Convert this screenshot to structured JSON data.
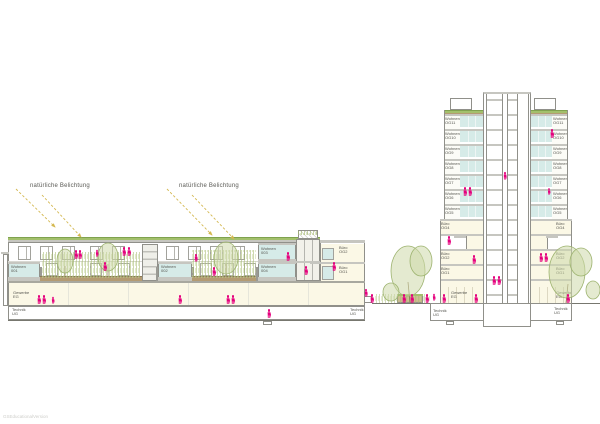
{
  "annotations": {
    "natural_light_1": "natürliche Belichtung",
    "natural_light_2": "natürliche Belichtung"
  },
  "watermark": "GSEducationalVersion",
  "colors": {
    "magenta": "#e5007d",
    "glazing": "#d6ebe8",
    "room_cream": "#fbf8e6",
    "roof_green": "#a3c06c",
    "soil_brown": "#b49b72",
    "arrow_yellow": "#d4b850",
    "plant_green": "#a7bb70",
    "line_gray": "#90908a"
  },
  "left_building": {
    "units": [
      {
        "name": "Wohnen",
        "num": "001"
      },
      {
        "name": "Wohnen",
        "num": "002"
      },
      {
        "name": "Wohnen",
        "num": "003"
      },
      {
        "name": "Wohnen",
        "num": "004"
      }
    ],
    "office_block": {
      "floors": [
        {
          "name": "Büro",
          "num": "OG2"
        },
        {
          "name": "Büro",
          "num": "OG1"
        },
        {
          "name": "Büro",
          "num": "EG"
        }
      ],
      "basement": {
        "name": "Technik",
        "num": "UG"
      }
    },
    "podium": {
      "commercial": {
        "name": "Gewerbe",
        "num": "EG"
      },
      "basement": {
        "name": "Technik",
        "num": "UG"
      }
    }
  },
  "tower": {
    "left_wing_floors": [
      {
        "name": "Wohnen",
        "num": "OG11",
        "type": "wohnen"
      },
      {
        "name": "Wohnen",
        "num": "OG10",
        "type": "wohnen"
      },
      {
        "name": "Wohnen",
        "num": "OG9",
        "type": "wohnen"
      },
      {
        "name": "Wohnen",
        "num": "OG8",
        "type": "wohnen"
      },
      {
        "name": "Wohnen",
        "num": "OG7",
        "type": "wohnen"
      },
      {
        "name": "Wohnen",
        "num": "OG6",
        "type": "wohnen"
      },
      {
        "name": "Wohnen",
        "num": "OG5",
        "type": "wohnen"
      },
      {
        "name": "Büro",
        "num": "OG4",
        "type": "buero"
      },
      {
        "type": "terrace"
      },
      {
        "name": "Büro",
        "num": "OG2",
        "type": "buero"
      },
      {
        "name": "Büro",
        "num": "OG1",
        "type": "buero"
      },
      {
        "name": "Gewerbe",
        "num": "EG",
        "type": "gewerbe"
      }
    ],
    "right_wing_floors": [
      {
        "name": "Wohnen",
        "num": "OG11",
        "type": "wohnen"
      },
      {
        "name": "Wohnen",
        "num": "OG10",
        "type": "wohnen"
      },
      {
        "name": "Wohnen",
        "num": "OG9",
        "type": "wohnen"
      },
      {
        "name": "Wohnen",
        "num": "OG8",
        "type": "wohnen"
      },
      {
        "name": "Wohnen",
        "num": "OG7",
        "type": "wohnen"
      },
      {
        "name": "Wohnen",
        "num": "OG6",
        "type": "wohnen"
      },
      {
        "name": "Wohnen",
        "num": "OG5",
        "type": "wohnen"
      },
      {
        "name": "Büro",
        "num": "OG4",
        "type": "buero"
      },
      {
        "type": "terrace"
      },
      {
        "name": "Büro",
        "num": "OG2",
        "type": "buero"
      },
      {
        "name": "Büro",
        "num": "OG1",
        "type": "buero"
      },
      {
        "name": "Gewerbe",
        "num": "EG",
        "type": "gewerbe"
      }
    ],
    "basement_left": {
      "name": "Technik",
      "num": "UG"
    },
    "basement_right": {
      "name": "Technik",
      "num": "UG"
    }
  },
  "figures": [
    {
      "x": 76,
      "y": 259
    },
    {
      "x": 80,
      "y": 259
    },
    {
      "x": 97,
      "y": 257,
      "s": 0.8
    },
    {
      "x": 105,
      "y": 271
    },
    {
      "x": 124,
      "y": 256
    },
    {
      "x": 129,
      "y": 256
    },
    {
      "x": 196,
      "y": 262,
      "s": 0.9
    },
    {
      "x": 214,
      "y": 276
    },
    {
      "x": 288,
      "y": 261
    },
    {
      "x": 306,
      "y": 275
    },
    {
      "x": 334,
      "y": 271
    },
    {
      "x": 39,
      "y": 304
    },
    {
      "x": 44,
      "y": 304
    },
    {
      "x": 53,
      "y": 304,
      "s": 0.8
    },
    {
      "x": 180,
      "y": 304
    },
    {
      "x": 228,
      "y": 304
    },
    {
      "x": 233,
      "y": 304
    },
    {
      "x": 269,
      "y": 318
    },
    {
      "x": 366,
      "y": 297,
      "s": 0.9
    },
    {
      "x": 372,
      "y": 303
    },
    {
      "x": 404,
      "y": 303
    },
    {
      "x": 412,
      "y": 303
    },
    {
      "x": 427,
      "y": 303
    },
    {
      "x": 434,
      "y": 301,
      "s": 0.8
    },
    {
      "x": 444,
      "y": 303
    },
    {
      "x": 465,
      "y": 196
    },
    {
      "x": 470,
      "y": 196
    },
    {
      "x": 505,
      "y": 180,
      "s": 0.9
    },
    {
      "x": 552,
      "y": 138
    },
    {
      "x": 549,
      "y": 195,
      "s": 0.75
    },
    {
      "x": 449,
      "y": 245
    },
    {
      "x": 474,
      "y": 264
    },
    {
      "x": 541,
      "y": 262
    },
    {
      "x": 546,
      "y": 262
    },
    {
      "x": 494,
      "y": 285
    },
    {
      "x": 499,
      "y": 285
    },
    {
      "x": 476,
      "y": 303
    },
    {
      "x": 568,
      "y": 303
    }
  ]
}
